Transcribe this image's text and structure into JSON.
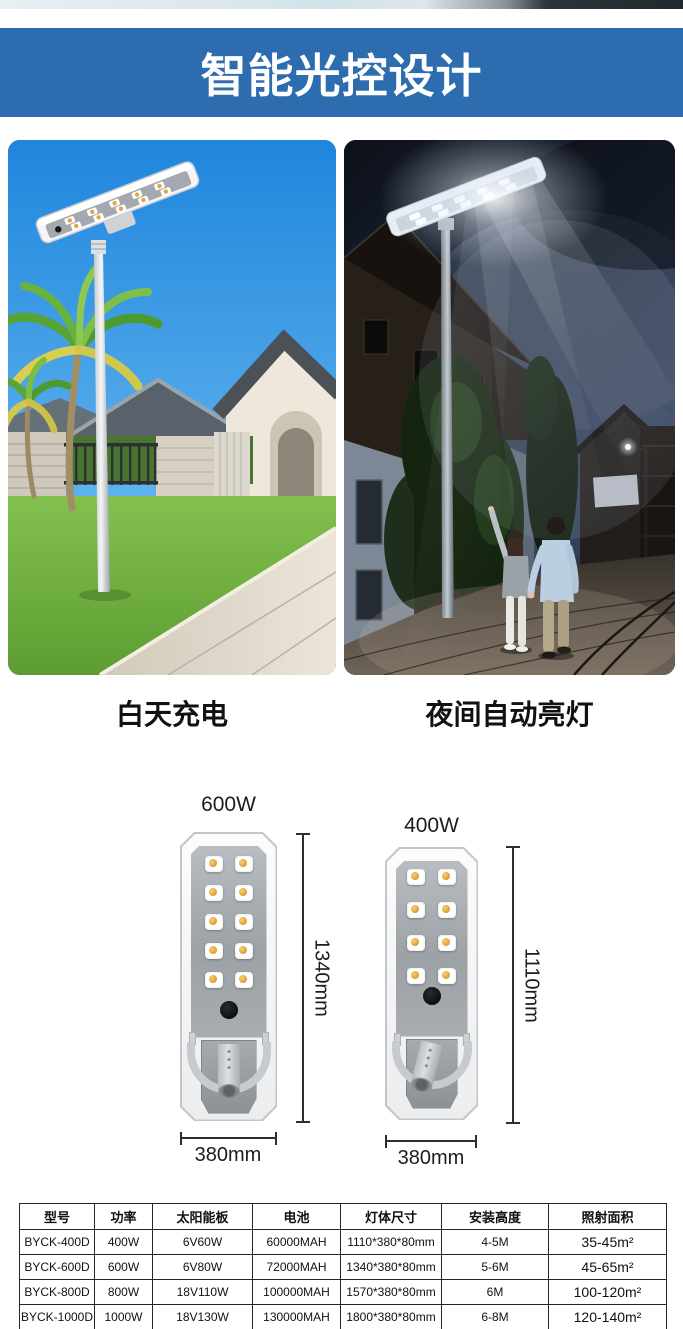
{
  "banner": {
    "title": "智能光控设计"
  },
  "photos": {
    "left": {
      "caption": "白天充电"
    },
    "right": {
      "caption": "夜间自动亮灯"
    }
  },
  "diagrams": {
    "left": {
      "power": "600W",
      "height": "1340mm",
      "width": "380mm",
      "led": {
        "rows": 5,
        "cols": 2
      }
    },
    "right": {
      "power": "400W",
      "height": "1110mm",
      "width": "380mm",
      "led": {
        "rows": 4,
        "cols": 2
      }
    }
  },
  "spec_table": {
    "headers": [
      "型号",
      "功率",
      "太阳能板",
      "电池",
      "灯体尺寸",
      "安装高度",
      "照射面积"
    ],
    "rows": [
      {
        "model": "BYCK-400D",
        "power": "400W",
        "solar_panel": "6V60W",
        "battery": "60000MAH",
        "body_size": "1110*380*80mm",
        "install_height": "4-5M",
        "coverage": "35-45m²"
      },
      {
        "model": "BYCK-600D",
        "power": "600W",
        "solar_panel": "6V80W",
        "battery": "72000MAH",
        "body_size": "1340*380*80mm",
        "install_height": "5-6M",
        "coverage": "45-65m²"
      },
      {
        "model": "BYCK-800D",
        "power": "800W",
        "solar_panel": "18V110W",
        "battery": "100000MAH",
        "body_size": "1570*380*80mm",
        "install_height": "6M",
        "coverage": "100-120m²"
      },
      {
        "model": "BYCK-1000D",
        "power": "1000W",
        "solar_panel": "18V130W",
        "battery": "130000MAH",
        "body_size": "1800*380*80mm",
        "install_height": "6-8M",
        "coverage": "120-140m²"
      }
    ]
  },
  "colors": {
    "banner_bg": "#2d6cae",
    "banner_text": "#ffffff",
    "led_dot": "#dd9b28",
    "table_border": "#262626"
  }
}
